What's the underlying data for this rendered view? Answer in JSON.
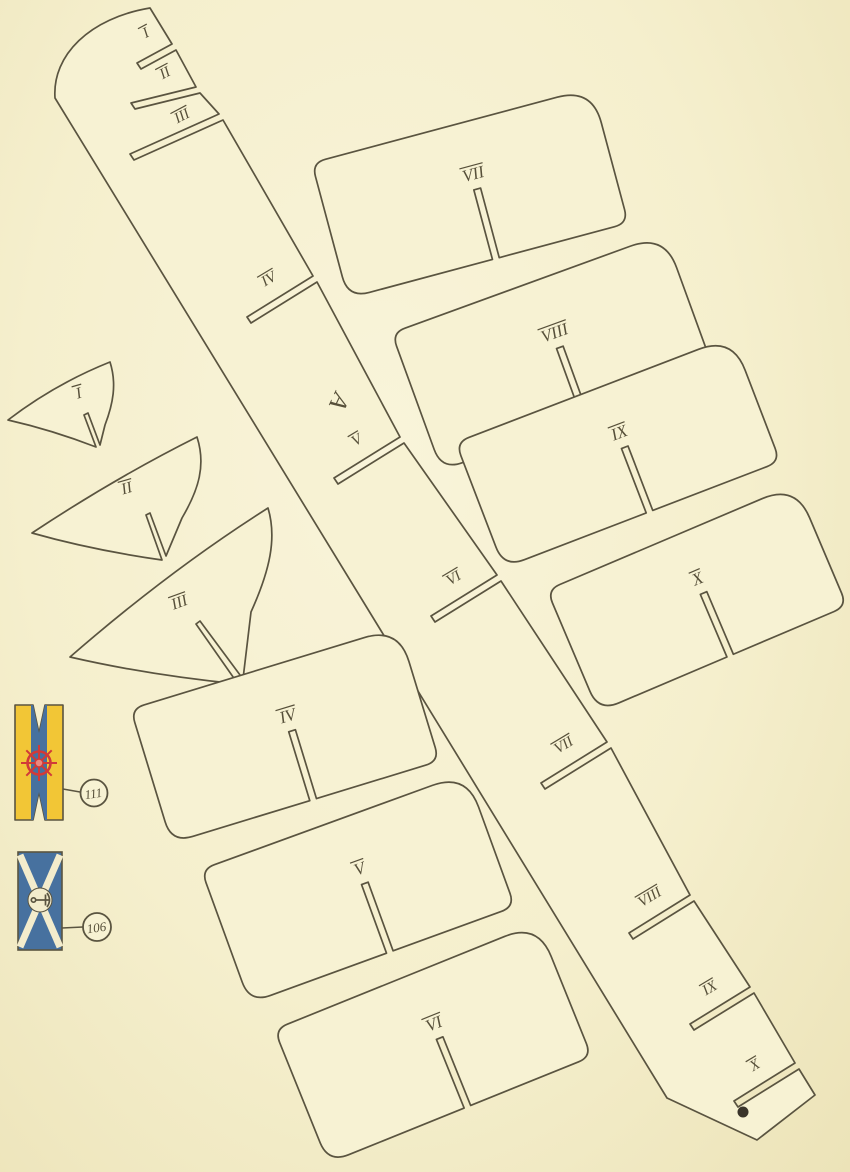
{
  "colors": {
    "paper": "#f7f2d3",
    "ink": "#5a5440",
    "flag_yellow": "#f2c636",
    "flag_blue": "#47719f",
    "wheel_red": "#d13a38",
    "wheel_hub": "#e98a80",
    "saltire_cream": "#f3eccc",
    "dot": "#3a342a"
  },
  "keel": {
    "letter": "A",
    "slot_labels": [
      "I",
      "II",
      "III",
      "IV",
      "V",
      "VI",
      "VII",
      "VIII",
      "IX",
      "X"
    ]
  },
  "bow_frames": [
    "I",
    "II",
    "III"
  ],
  "hull_panels": [
    "IV",
    "V",
    "VI",
    "VII",
    "VIII",
    "IX",
    "X"
  ],
  "emblems": {
    "wheel_pennant": {
      "part_number": "111"
    },
    "anchor_pennant": {
      "part_number": "106"
    }
  }
}
